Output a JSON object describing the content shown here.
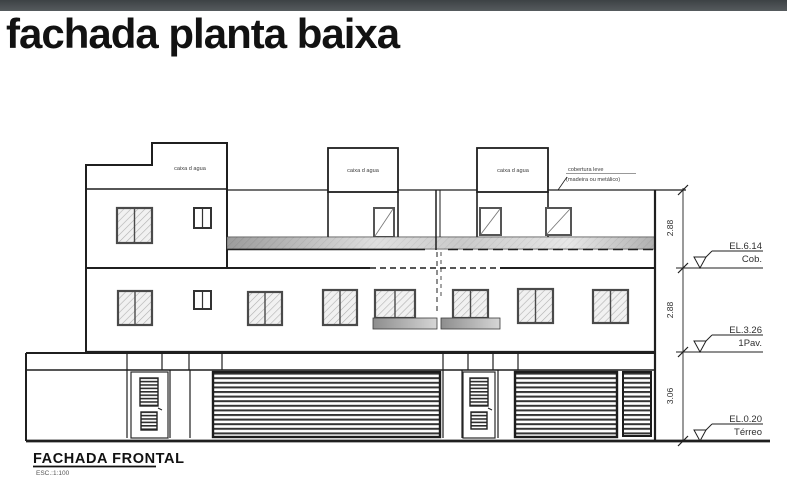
{
  "page": {
    "topbar_color": "#454a4d",
    "background": "#ffffff"
  },
  "title": "fachada planta baixa",
  "drawing": {
    "water_tank_label": "caixa d agua",
    "roof_label_line1": "cobertura leve",
    "roof_label_line2": "(madeira ou metálico)"
  },
  "dimensions": {
    "upper": "2.88",
    "middle": "2.88",
    "lower": "3.06"
  },
  "elevations": {
    "cob": {
      "value": "EL.6.14",
      "name": "Cob."
    },
    "pav1": {
      "value": "EL.3.26",
      "name": "1Pav."
    },
    "terreo": {
      "value": "EL.0.20",
      "name": "Térreo"
    }
  },
  "footer": {
    "title": "FACHADA FRONTAL",
    "scale": "ESC.:1:100"
  },
  "colors": {
    "line": "#1f1f1f",
    "hatch": "#b0b0b0",
    "band_dark": "#868686",
    "band_light": "#dedede"
  }
}
